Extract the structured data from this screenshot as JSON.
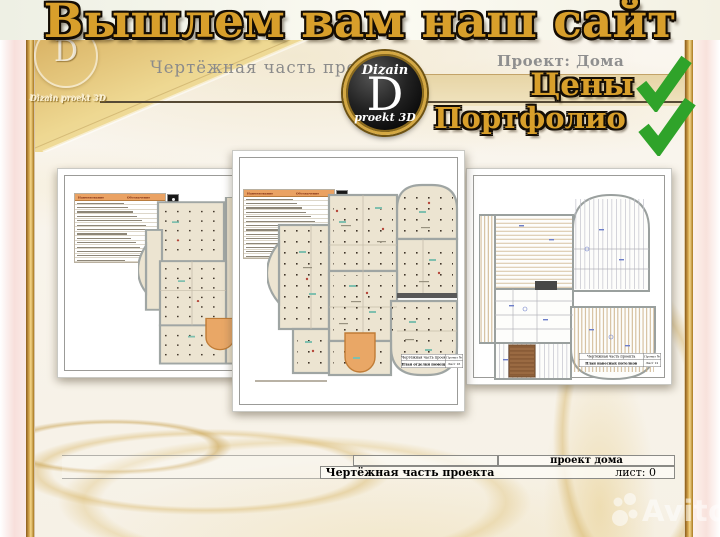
{
  "banner": {
    "title": "Вышлем вам наш сайт"
  },
  "header": {
    "subtitle": "Чертёжная часть проекта",
    "project_label": "Проект: Дома",
    "corner_logo_letter": "D",
    "corner_logo_caption": "Dizain proekt 3D",
    "logo": {
      "top": "Dizain",
      "letter": "D",
      "bottom": "proekt 3D"
    },
    "links": [
      {
        "label": "Цены"
      },
      {
        "label": "Портфолио"
      }
    ]
  },
  "legend": {
    "header_left": "Наименование",
    "header_right": "Обозначение",
    "row_count": 14,
    "side_mark_count": 8
  },
  "sheets": {
    "middle": {
      "stamp": {
        "r1l": "Чертёжная часть проекта",
        "r1r": "Проект №",
        "r2l": "План отделки помещений",
        "r2r": "Лист 16"
      }
    },
    "right": {
      "stamp": {
        "r1l": "Чертёжная часть проекта",
        "r1r": "Проект №",
        "r2l": "План навесных потолков",
        "r2r": "Лист 12"
      }
    }
  },
  "title_block": {
    "project": "проект дома",
    "title": "Чертёжная часть проекта",
    "sheet": "лист: 0"
  },
  "watermark": {
    "label": "Avito"
  },
  "colors": {
    "gold": "#d89f2b",
    "green": "#2fa32a",
    "tan_strip": "#e5d3a3",
    "orange_room": "#e9a766",
    "teal_mark": "#7fbfae"
  }
}
